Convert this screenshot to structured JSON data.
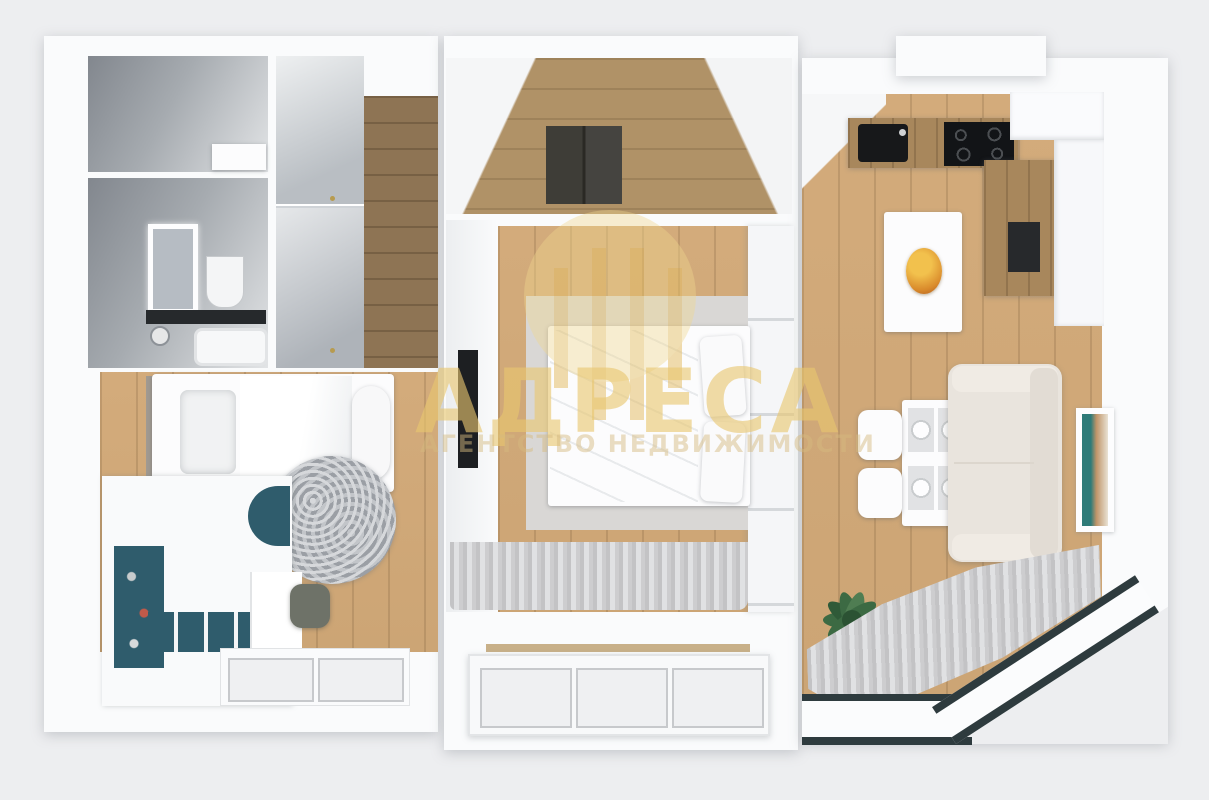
{
  "meta": {
    "description": "3D top-down render of a two-bedroom apartment floor plan (real-estate listing image)",
    "canvas": {
      "width": 1209,
      "height": 800
    }
  },
  "watermark": {
    "icon": "building-columns-icon",
    "title": "АДРЕСА",
    "subtitle": "АГЕНТСТВО НЕДВИЖИМОСТИ",
    "color": "#E8C46E"
  },
  "palette": {
    "background": "#edeef0",
    "walls": "#fafbfc",
    "wall_shadow": "#82878e",
    "floor_wood_room": "#d0a878",
    "floor_wood_hall": "#b09267",
    "floor_wood_corridor": "#8e7454",
    "kitchen_counter_wood": "#a8875c",
    "rug_gray": "#aeb1b6",
    "bed_rug_gray": "#d9d7d5",
    "curtain_gray": "#c9c9cb",
    "balcony_frame_dark": "#2e3b3e",
    "accent_teal_shelves": "#2f5c6c",
    "plant_green": "#3c6a43",
    "sofa_cream": "#e9e4dd",
    "appliance_black": "#17181a",
    "fruit_bowl_orange": "#d98a2b"
  },
  "scene": {
    "rooms": [
      {
        "name": "wc",
        "furniture": [
          "shelf"
        ]
      },
      {
        "name": "bathroom",
        "furniture": [
          "led-mirror",
          "vanity-counter",
          "shower-fixture",
          "toilet",
          "bathtub"
        ]
      },
      {
        "name": "hallway-closet",
        "furniture": [
          "wardrobe-doors",
          "corridor-floor"
        ]
      },
      {
        "name": "entry-hall",
        "furniture": [
          "doormat"
        ]
      },
      {
        "name": "kids-bedroom",
        "furniture": [
          "single-bed",
          "round-rug",
          "desk-unit",
          "teal-shelves",
          "desk-chair",
          "window"
        ]
      },
      {
        "name": "main-bedroom",
        "furniture": [
          "double-bed",
          "area-rug",
          "wardrobe",
          "tv-panel",
          "curtains",
          "loggia-window"
        ]
      },
      {
        "name": "living-kitchen",
        "furniture": [
          "kitchen-sink",
          "cooktop",
          "kitchen-counter",
          "tall-cabinets",
          "island",
          "fruit-bowl",
          "dining-table",
          "dining-chairs",
          "sofa",
          "wall-art",
          "potted-plant",
          "curtains",
          "bay-window"
        ]
      }
    ]
  }
}
